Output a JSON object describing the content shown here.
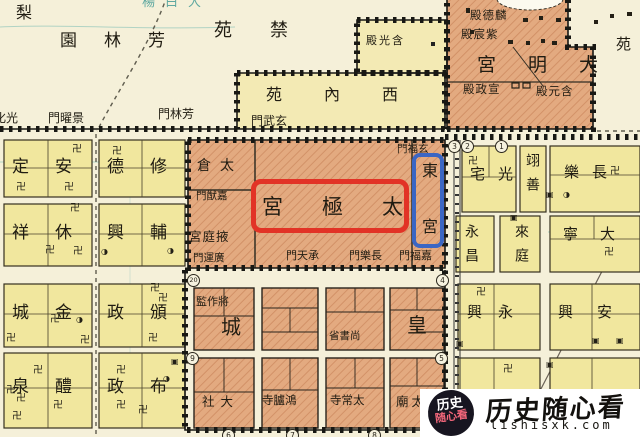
{
  "labels": {
    "pear": "梨",
    "fanglin_garden": "園林芳",
    "jinyuan": "苑禁",
    "dabaiyang": "楊白大",
    "yuan_ne": "苑",
    "gate_guanghua": "化光",
    "gate_jingyao": "門曜景",
    "gate_fanglin": "門林芳",
    "gate_xuanwu": "門武玄",
    "west_inner_garden": "苑內西",
    "hanguang_hall": "殿光含",
    "daming_palace": "宮明大",
    "linde_hall": "殿德麟",
    "zichen_hall": "殿宸紫",
    "xuanzheng_hall": "殿政宣",
    "hanyuan_hall": "殿元含",
    "taicang": "倉太",
    "gate_jiayou": "門猷嘉",
    "yeting_palace": "宮庭掖",
    "gate_guangyun": "門運廣",
    "taiji_palace": "宮極太",
    "east_palace": "東宮",
    "gate_xuanfu": "門福玄",
    "gate_chengtian": "門天承",
    "gate_changle": "門樂長",
    "gate_jiafu": "門福嘉",
    "jiangzuojian": "監作將",
    "cheng": "城",
    "huang": "皇",
    "shangshusheng": "省書尚",
    "dashe": "社大",
    "honglusi": "寺臚鴻",
    "taichangsi": "寺常太",
    "taimiao": "廟太",
    "wards_west": {
      "r1c1": "定安",
      "r1c2": "德修",
      "r2c1": "祥休",
      "r2c2": "興輔",
      "r3c1": "城金",
      "r3c2": "政頒",
      "r4c1": "泉醴",
      "r4c2": "政布"
    },
    "wards_east": {
      "guangzhai": "宅光",
      "yishan": "翊善",
      "changle": "樂長",
      "yongchang": "永昌",
      "laiting": "來庭",
      "daning": "寧大",
      "yongxing": "興永",
      "anxing": "興安"
    }
  },
  "numbers": {
    "n1": "1",
    "n2": "2",
    "n3": "3",
    "n4": "4",
    "n5": "5",
    "n6": "6",
    "n7": "7",
    "n8": "8",
    "n9": "9",
    "n20": "20"
  },
  "symbols": {
    "temple": "卍",
    "shrine": "◑",
    "building": "▣"
  },
  "watermark": {
    "badge_line1": "历史",
    "badge_line2": "随心看",
    "brand_calligraphy": "历史随心看",
    "site": "lishisxk.com"
  },
  "colors": {
    "ward_yellow": "#f1e79e",
    "palace_salmon": "#e3aa80",
    "highlight_red": "#e23326",
    "highlight_blue": "#3a66c4",
    "water_teal": "#79bcb2",
    "background_cream": "#f5f0d9"
  }
}
